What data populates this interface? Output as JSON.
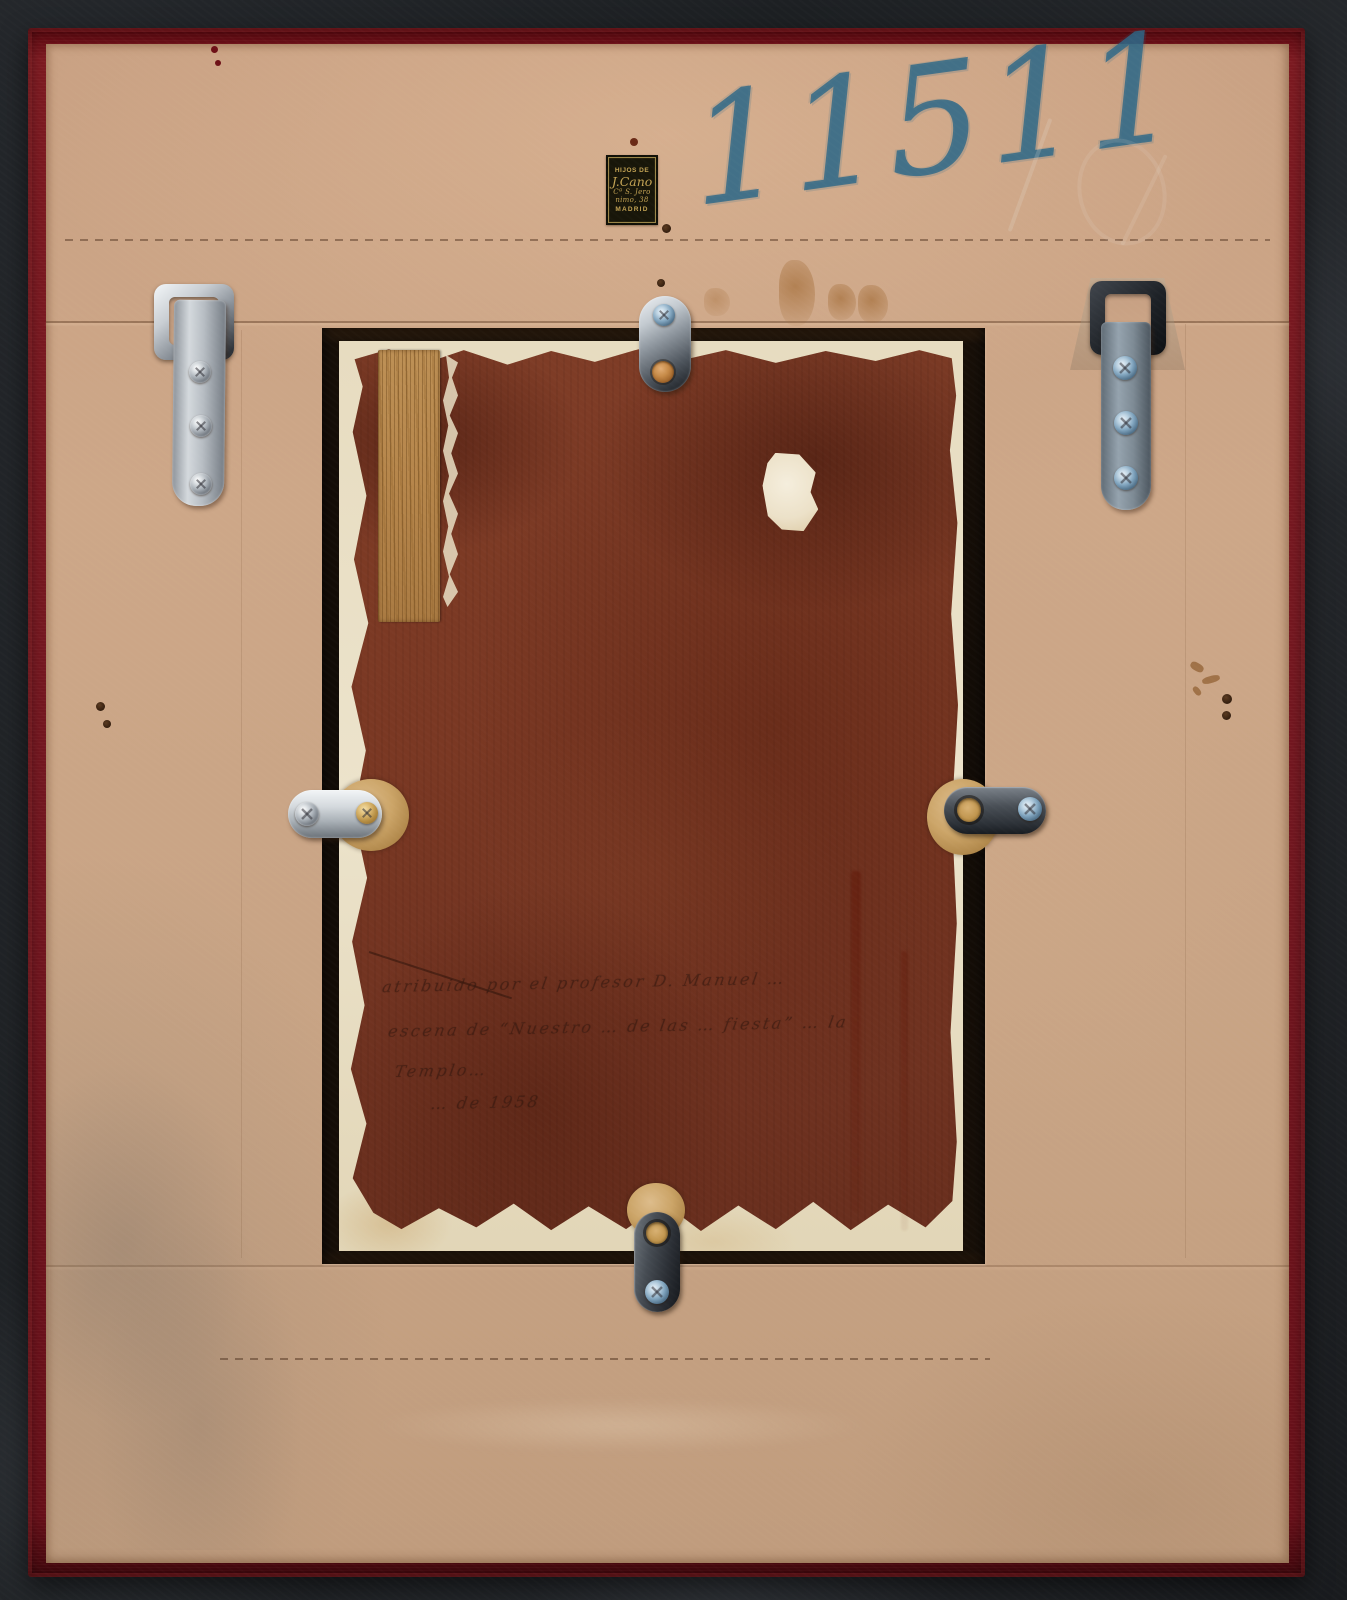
{
  "photo": {
    "inventory_number": "11511",
    "dealer_label": {
      "line1": "HIJOS DE",
      "line2": "J.Cano",
      "line3": "Cª S. Jero",
      "line4": "nimo, 38",
      "line5": "MADRID"
    },
    "panel_inscription": {
      "line1": "atribuido por el profesor D. Manuel …",
      "line2": "escena de “Nuestro … de las … fiesta” … la",
      "line3": "Templo…",
      "line4": "…  de  1958"
    },
    "colors": {
      "background": "#1f2226",
      "frame_velvet": "#701620",
      "backing_board": "#c8a284",
      "panel_paint": "#7a3824",
      "gesso_white": "#e9dec4",
      "chrome_metal": "#c3c8cd",
      "gunmetal": "#3f444b",
      "wood_patch": "#b98a50",
      "label_black": "#181609",
      "label_gold": "#c2a253",
      "crayon_blue": "#2d6888"
    }
  }
}
